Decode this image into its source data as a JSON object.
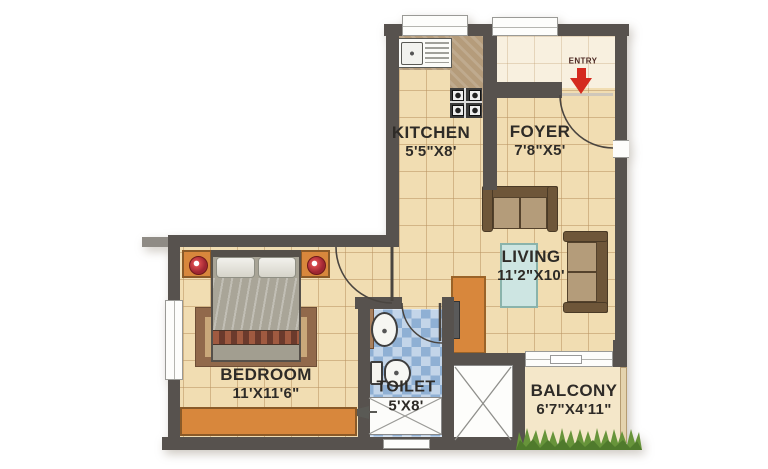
{
  "plan": {
    "entry": {
      "label": "ENTRY"
    },
    "rooms": {
      "kitchen": {
        "name": "KITCHEN",
        "dims": "5'5\"X8'"
      },
      "foyer": {
        "name": "FOYER",
        "dims": "7'8\"X5'"
      },
      "living": {
        "name": "LIVING",
        "dims": "11'2\"X10'"
      },
      "bedroom": {
        "name": "BEDROOM",
        "dims": "11'X11'6\""
      },
      "toilet": {
        "name": "TOILET",
        "dims": "5'X8'"
      },
      "balcony": {
        "name": "BALCONY",
        "dims": "6'7\"X4'11\""
      }
    },
    "colors": {
      "wall": "#57524e",
      "floor": "#f1ddb2",
      "floor_grid": "#ba9463",
      "entry_arrow_red": "#d42a1e",
      "furniture_orange": "#d8873c",
      "toilet_tile_blue": "#8fb0d4",
      "balcony_floor": "#f4e7c9",
      "grass_green": "#67943a",
      "sofa_brown": "#6e5639",
      "label_text": "#2e2b27"
    }
  }
}
